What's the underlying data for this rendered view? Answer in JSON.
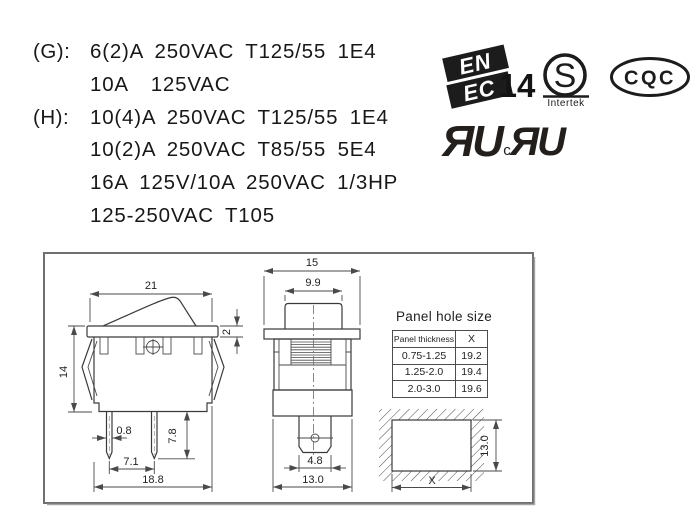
{
  "specs": {
    "lines": [
      {
        "label": "(G):",
        "text": "6(2)A 250VAC T125/55 1E4"
      },
      {
        "label": "",
        "text": "10A  125VAC"
      },
      {
        "label": "(H):",
        "text": "10(4)A 250VAC T125/55 1E4"
      },
      {
        "label": "",
        "text": "10(2)A 250VAC T85/55 5E4"
      },
      {
        "label": "",
        "text": "16A 125V/10A 250VAC 1/3HP"
      },
      {
        "label": "",
        "text": "125-250VAC T105"
      }
    ]
  },
  "certifications": {
    "enec": {
      "line1": "EN",
      "line2": "EC",
      "number": "14"
    },
    "intertek": {
      "letter": "S",
      "label": "Intertek"
    },
    "cqc": {
      "label": "CQC"
    },
    "ul": {
      "mark1": "ЯU",
      "c": "c",
      "mark2": "ЯU"
    }
  },
  "side_view": {
    "dim_width_top": "21",
    "dim_bezel": "2",
    "dim_height": "14",
    "dim_pin_width": "0.8",
    "dim_pin_length": "7.8",
    "dim_pin_pitch": "7.1",
    "dim_base_width": "18.8"
  },
  "front_view": {
    "dim_width": "15",
    "dim_rocker": "9.9",
    "dim_terminal": "4.8",
    "dim_body": "13.0"
  },
  "panel_cutout": {
    "dim_height": "13.0",
    "dim_width": "X"
  },
  "panel_hole_table": {
    "title": "Panel hole size",
    "col1": "Panel thickness",
    "col2": "X",
    "rows": [
      [
        "0.75-1.25",
        "19.2"
      ],
      [
        "1.25-2.0",
        "19.4"
      ],
      [
        "2.0-3.0",
        "19.6"
      ]
    ]
  },
  "colors": {
    "line": "#3a3a3a",
    "frame": "#707070",
    "ink": "#181818"
  }
}
